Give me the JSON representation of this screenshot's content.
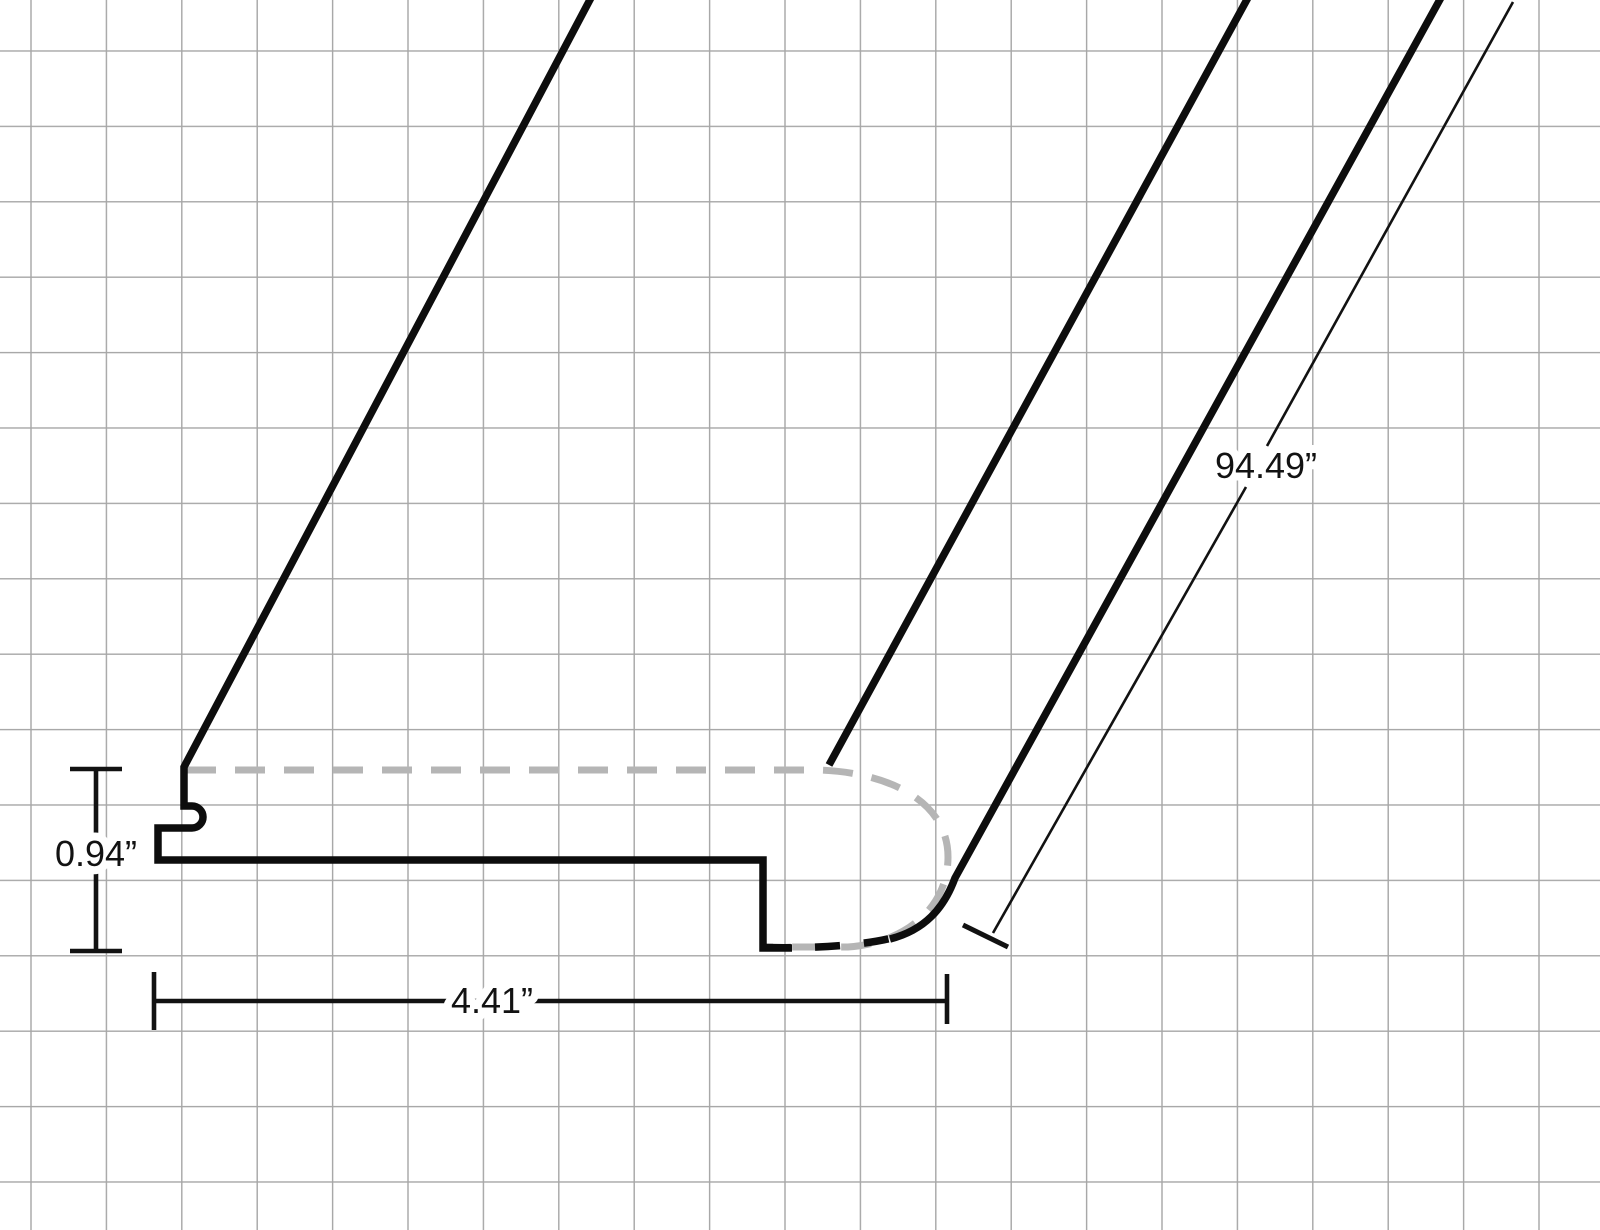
{
  "diagram": {
    "kind": "technical-dimension-drawing",
    "subject": "Stair nose molding profile drawn in perspective on grid paper",
    "dimension_labels": {
      "thickness": "0.94”",
      "width": "4.41”",
      "length": "94.49”"
    },
    "colors": {
      "background": "#ffffff",
      "grid": "#a6a6a6",
      "outline": "#0d0d0d",
      "hidden_contour": "#b5b5b5",
      "dimension": "#121212",
      "text": "#121212"
    },
    "grid_spacing_px": 75.4
  }
}
